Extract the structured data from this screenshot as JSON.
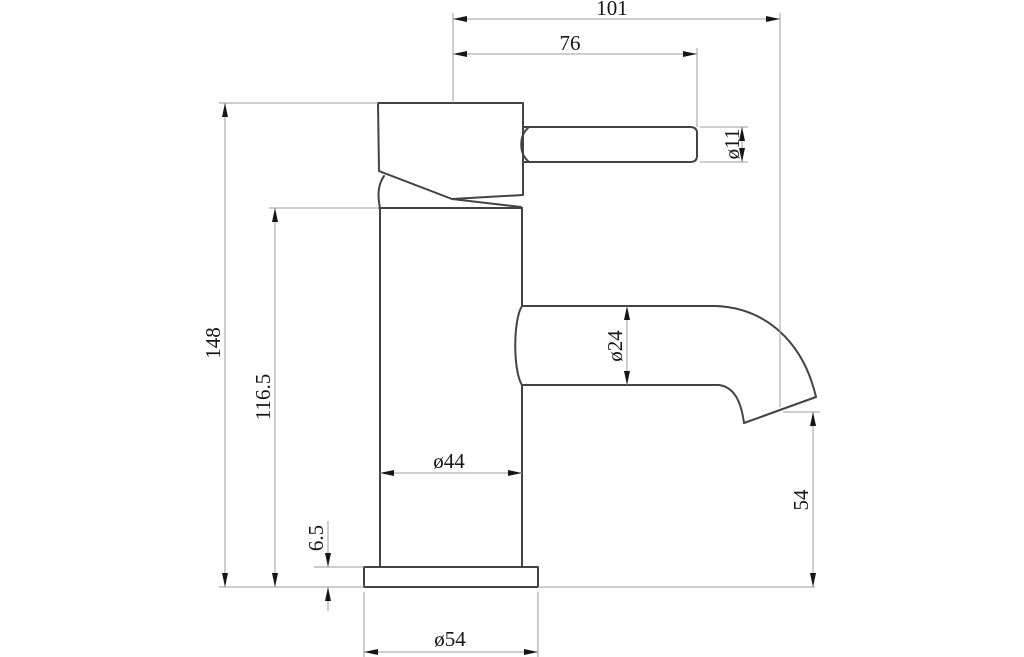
{
  "drawing": {
    "description": "Technical dimension drawing, side profile of a single-lever basin mixer tap",
    "unit_system": "mm",
    "colors": {
      "background": "#ffffff",
      "outline": "#434343",
      "dimension_lines": "#9d9d9d",
      "text_and_arrows": "#161616"
    },
    "dimensions": {
      "reach_overall": {
        "label": "101"
      },
      "reach_handle": {
        "label": "76"
      },
      "lever_diameter": {
        "label": "ø11"
      },
      "spout_tube_diameter": {
        "label": "ø24"
      },
      "spout_outlet_height": {
        "label": "54"
      },
      "overall_height": {
        "label": "148"
      },
      "body_height": {
        "label": "116.5"
      },
      "base_plate_thickness": {
        "label": "6.5"
      },
      "body_diameter": {
        "label": "ø44"
      },
      "base_plate_diameter": {
        "label": "ø54"
      }
    }
  }
}
